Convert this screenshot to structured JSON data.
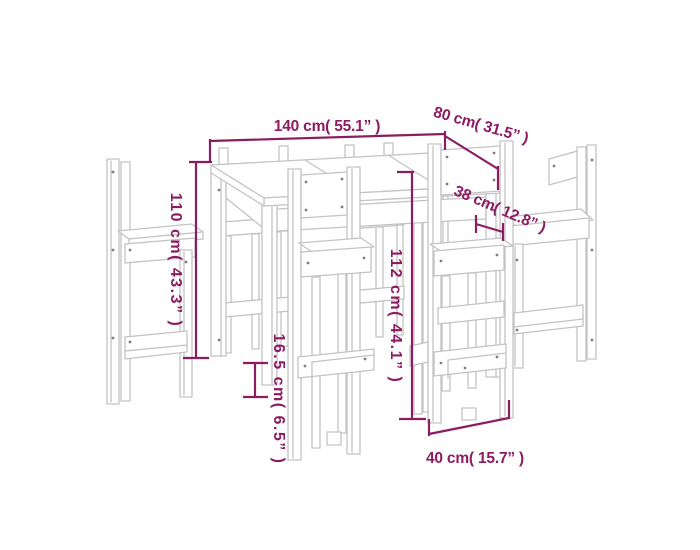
{
  "diagram": {
    "kind": "furniture-dimension-drawing",
    "subject": "bar table with six bar stools (wireframe line drawing)"
  },
  "colors": {
    "background": "#ffffff",
    "furniture_line": "#c3c3c3",
    "dimension": "#8c1c62"
  },
  "annotations": {
    "table_length": "140 cm( 55.1” )",
    "table_depth": "80 cm( 31.5” )",
    "table_height": "110 cm( 43.3” )",
    "stool_height": "112 cm( 44.1” )",
    "stool_seat_depth": "38 cm( 12.8” )",
    "stool_footrest_height": "16.5 cm( 6.5” )",
    "stool_seat_width": "40 cm( 15.7” )"
  }
}
